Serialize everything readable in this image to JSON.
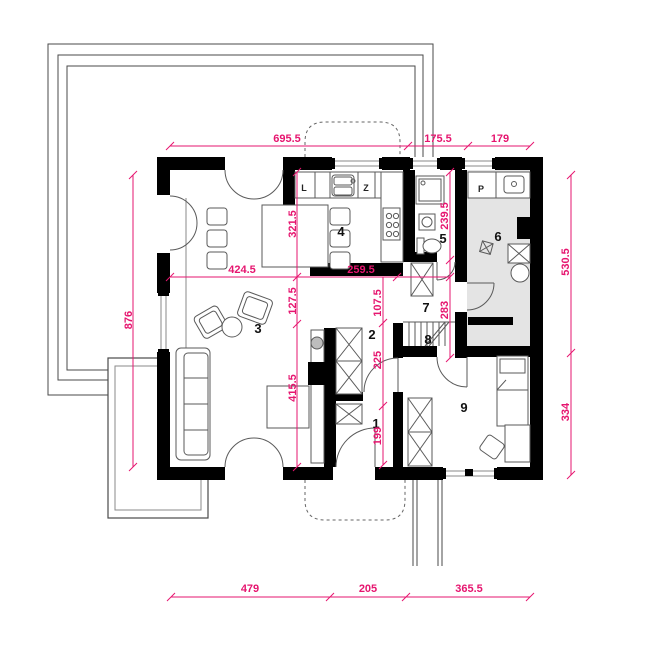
{
  "plan": {
    "colors": {
      "dimension": "#e6156f",
      "wall": "#000000",
      "utility_floor": "#e4e4e4"
    },
    "rooms": {
      "r1": "1",
      "r2": "2",
      "r3": "3",
      "r4": "4",
      "r5": "5",
      "r6": "6",
      "r7": "7",
      "r8": "8",
      "r9": "9"
    },
    "fixtures": {
      "fridge": "L",
      "sink": "Z",
      "washer": "P"
    },
    "dims": {
      "top_main": "695.5",
      "top_mid": "175.5",
      "top_right": "179",
      "left_outer": "876",
      "right_upper": "530.5",
      "right_lower": "334",
      "bottom_left": "479",
      "bottom_mid": "205",
      "bottom_right": "365.5",
      "kitchen_height": "321.5",
      "dining_width": "424.5",
      "kitchen_width": "259.5",
      "passage_height": "127.5",
      "living_height": "415.5",
      "hall_upper": "107.5",
      "hall_mid": "225",
      "entry_height": "199",
      "bath_height": "239.5",
      "stairhall_height": "283"
    }
  }
}
